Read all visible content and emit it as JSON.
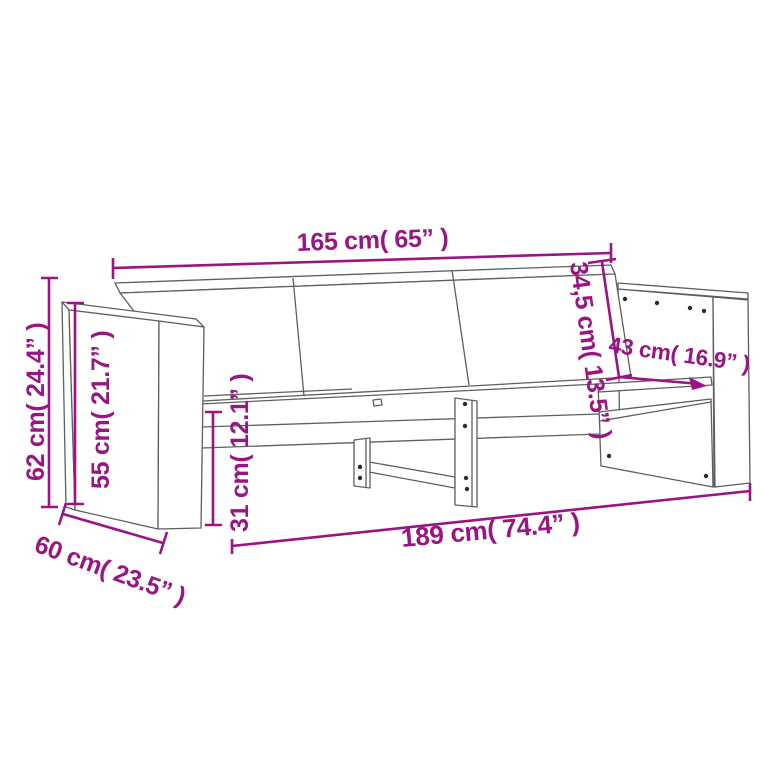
{
  "diagram": {
    "type": "furniture-dimension-diagram",
    "subject": "3-seater wooden garden sofa, wireframe line drawing with measurement annotations",
    "colors": {
      "dimension_accent": "#9A1583",
      "drawing_line": "#5F5F5F",
      "screw_dot": "#2B2B2B",
      "background": "#FFFFFF"
    },
    "dimensions": [
      {
        "id": "back_width",
        "cm": "165",
        "inches": "65",
        "label": "165 cm( 65” )"
      },
      {
        "id": "backrest_slant",
        "cm": "34,5",
        "inches": "13.5",
        "label": "34,5 cm( 13.5” )"
      },
      {
        "id": "armrest_depth",
        "cm": "43",
        "inches": "16.9",
        "label": "43 cm( 16.9” )"
      },
      {
        "id": "overall_height",
        "cm": "62",
        "inches": "24.4",
        "label": "62 cm( 24.4” )"
      },
      {
        "id": "armrest_height",
        "cm": "55",
        "inches": "21.7",
        "label": "55 cm( 21.7” )"
      },
      {
        "id": "seat_height",
        "cm": "31",
        "inches": "12.1",
        "label": "31 cm( 12.1” )"
      },
      {
        "id": "depth",
        "cm": "60",
        "inches": "23.5",
        "label": "60 cm( 23.5” )"
      },
      {
        "id": "overall_width",
        "cm": "189",
        "inches": "74.4",
        "label": "189 cm( 74.4” )"
      }
    ]
  }
}
